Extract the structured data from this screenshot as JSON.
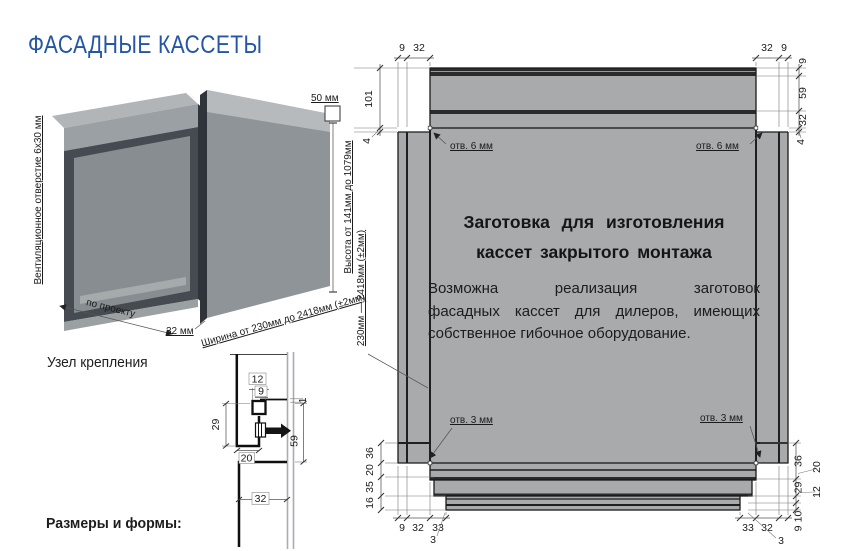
{
  "colors": {
    "accent_blue": "#2456a5",
    "sheet_grey": "#a8aaac",
    "line_dark": "#1a1a1a"
  },
  "header": {
    "title": "ФАСАДНЫЕ КАССЕТЫ"
  },
  "illustration": {
    "vent_label": "Вентиляционное отверстие 6х30 мм",
    "project_label": "по проекту",
    "depth_label": "32 мм",
    "flange_label": "50 мм",
    "height_label": "Высота от 141мм до 1079мм",
    "width_label": "Ширина от 230мм до 2418мм (±2мм)"
  },
  "mounting": {
    "section_label": "Узел крепления",
    "dims": {
      "top": "12",
      "hook": "9",
      "gap": "1",
      "left": "29",
      "return": "20",
      "right": "59",
      "bottom": "32"
    }
  },
  "footer": {
    "sizes_label": "Размеры и формы:"
  },
  "blank": {
    "title_line1": "Заготовка для изготовления",
    "title_line2": "кассет закрытого монтажа",
    "body_line1": "Возможна реализация заготовок",
    "body_line2": "фасадных кассет для дилеров, имеющих",
    "body_line3": "собственное гибочное оборудование.",
    "side_range_label": "230мм — 2418мм (±2мм)",
    "hole6": "отв. 6 мм",
    "hole3": "отв. 3 мм",
    "dims": {
      "tl_h1": "9",
      "tl_h2": "32",
      "tl_v1": "101",
      "tl_v2": "4",
      "tr_h1": "32",
      "tr_h2": "9",
      "tr_v1": "9",
      "tr_v2": "59",
      "tr_v3": "32",
      "tr_v4": "4",
      "bl_v1": "36",
      "bl_v2": "20",
      "bl_v3": "35",
      "bl_v4": "16",
      "bl_h1": "9",
      "bl_h2": "32",
      "bl_h3": "33",
      "bl_lead": "3",
      "br_v1": "36",
      "br_v2": "29",
      "br_v3": "10",
      "br_v4": "9",
      "br_lead1": "20",
      "br_lead2": "12",
      "br_h1": "33",
      "br_h2": "32",
      "br_lead3": "3"
    }
  }
}
